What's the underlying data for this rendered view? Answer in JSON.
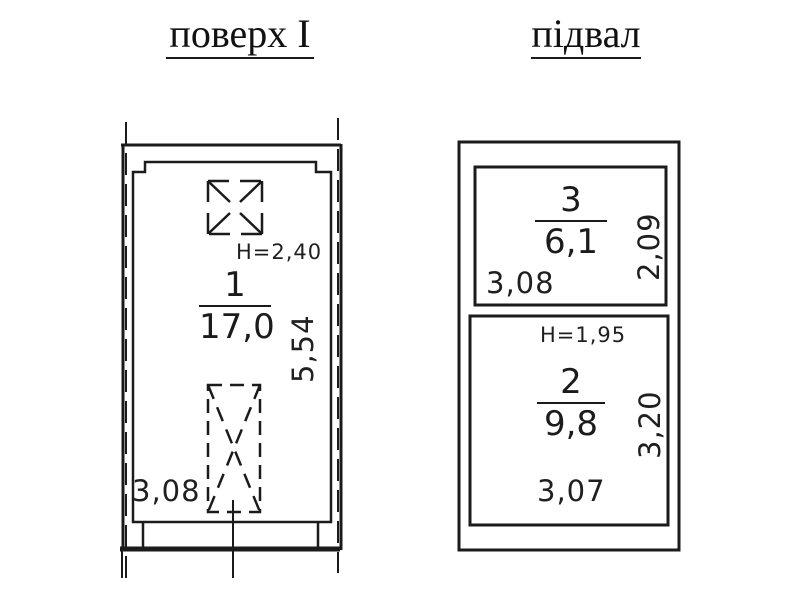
{
  "document": {
    "background": "#ffffff",
    "line_color": "#1b1b1b"
  },
  "floor_plan": {
    "title": "поверх I",
    "ceiling_height_label": "H=2,40",
    "room_number": "1",
    "room_area": "17,0",
    "dim_width": "3,08",
    "dim_depth": "5,54",
    "symbols": [
      "vent-shaft",
      "staircase"
    ]
  },
  "basement_plan": {
    "title": "підвал",
    "room3": {
      "number": "3",
      "area": "6,1",
      "dim_width": "3,08",
      "dim_depth": "2,09"
    },
    "room2": {
      "ceiling_height_label": "H=1,95",
      "number": "2",
      "area": "9,8",
      "dim_width": "3,07",
      "dim_depth": "3,20"
    }
  }
}
